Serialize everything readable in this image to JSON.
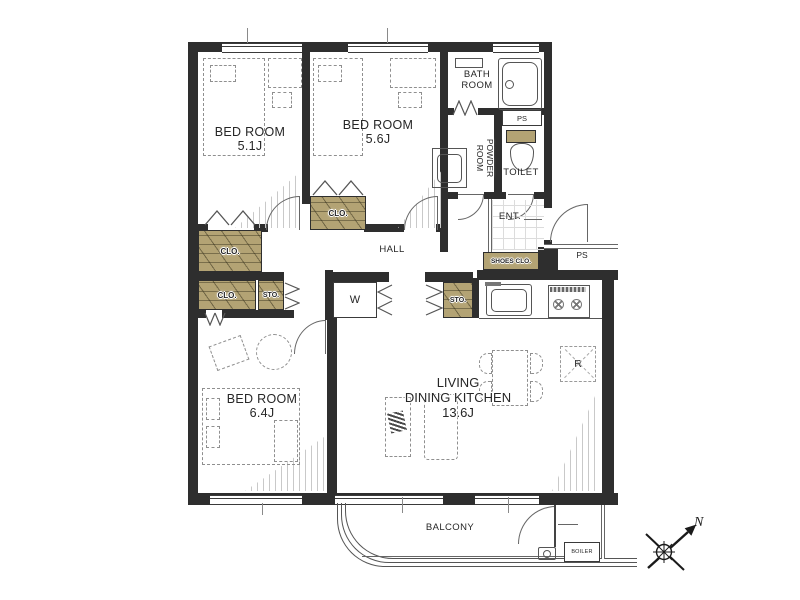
{
  "rooms": {
    "bedroom_small": {
      "label": "BED ROOM",
      "size": "5.1J"
    },
    "bedroom_mid": {
      "label": "BED ROOM",
      "size": "5.6J"
    },
    "bedroom_large": {
      "label": "BED ROOM",
      "size": "6.4J"
    },
    "ldk": {
      "line1": "LIVING",
      "line2": "DINING KITCHEN",
      "size": "13.6J"
    },
    "bath": {
      "line1": "BATH",
      "line2": "ROOM"
    },
    "powder": {
      "line1": "POWDER",
      "line2": "ROOM"
    },
    "toilet": {
      "label": "TOILET"
    },
    "hall": {
      "label": "HALL"
    },
    "entrance": {
      "label": "ENT."
    },
    "balcony": {
      "label": "BALCONY"
    }
  },
  "fixtures": {
    "closet": "CLO.",
    "storage": "STO.",
    "shoes_closet": "SHOES CLO.",
    "washer": "W",
    "refrigerator": "R",
    "boiler": "BOILER",
    "pipe_shaft": "PS"
  },
  "compass": {
    "north": "N"
  },
  "colors": {
    "wall": "#2e2e2e",
    "closet_fill": "#b3a374",
    "line": "#555555"
  }
}
